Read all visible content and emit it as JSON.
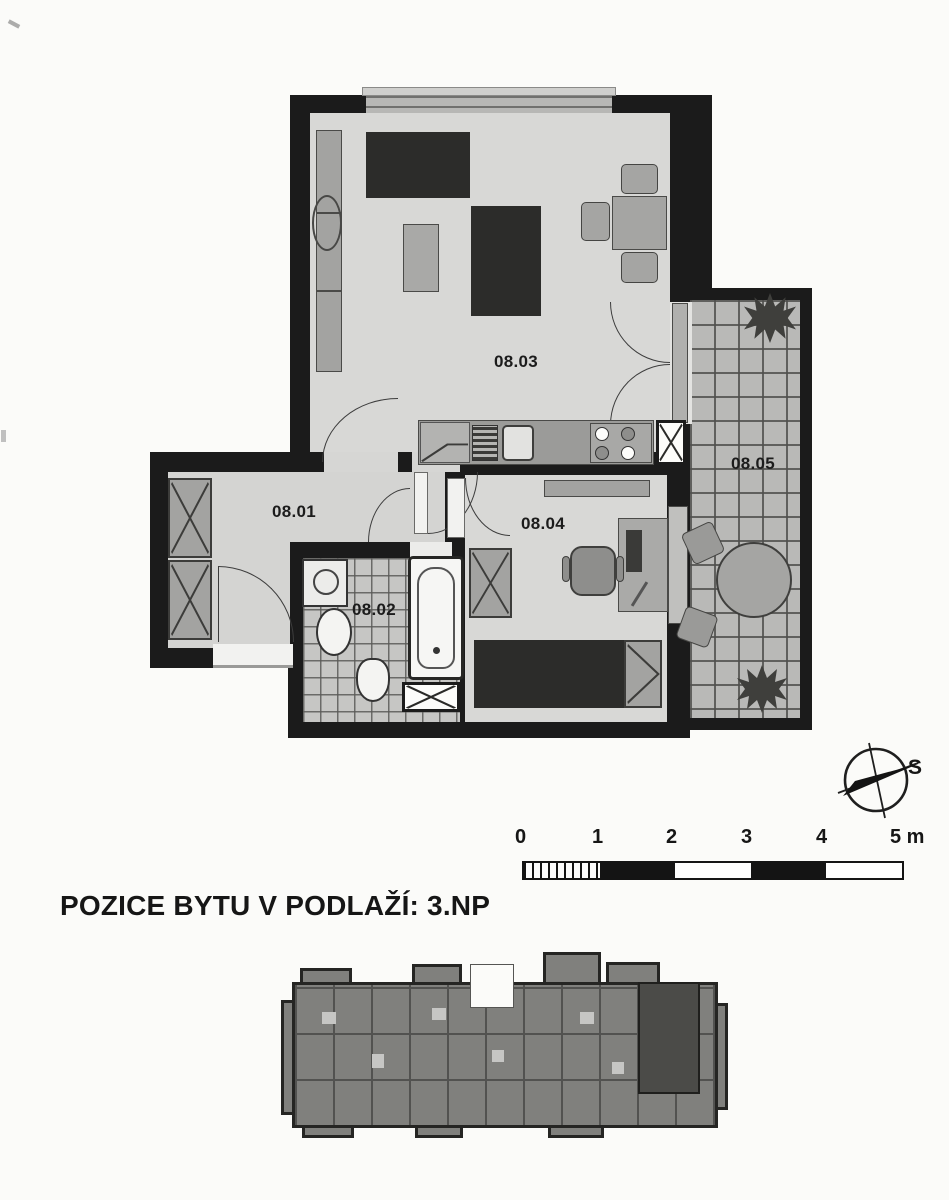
{
  "section_title": "POZICE BYTU V PODLAŽÍ: 3.NP",
  "floor_plan": {
    "rooms": [
      {
        "label": "08.01",
        "name": "hall"
      },
      {
        "label": "08.02",
        "name": "bathroom"
      },
      {
        "label": "08.03",
        "name": "living-room-with-kitchen"
      },
      {
        "label": "08.04",
        "name": "bedroom"
      },
      {
        "label": "08.05",
        "name": "terrace"
      }
    ],
    "colors": {
      "wall": "#1b1b1b",
      "floor": "#d8d8d6",
      "tile": "#c6c6c4",
      "furniture": "#a3a3a1",
      "furniture_dark": "#2c2c2a",
      "paper": "#fbfbf9"
    }
  },
  "compass": {
    "label": "S"
  },
  "scale_bar": {
    "ticks": [
      "0",
      "1",
      "2",
      "3",
      "4",
      "5 m"
    ]
  }
}
